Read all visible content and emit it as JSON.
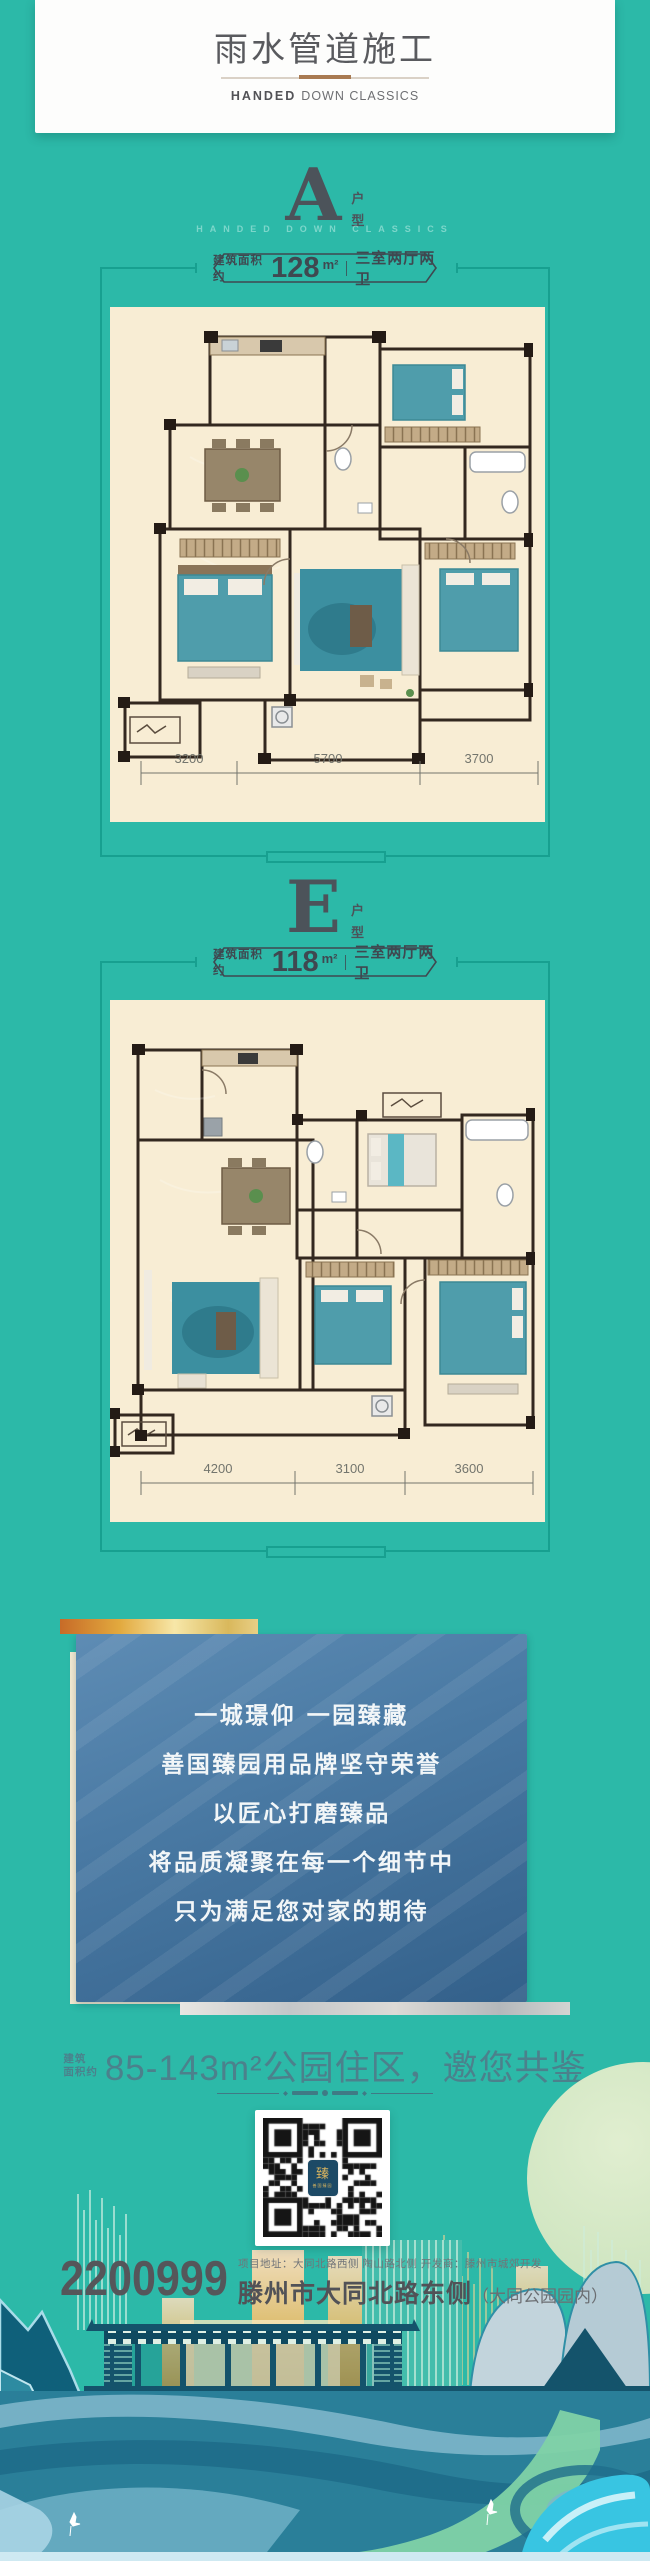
{
  "header": {
    "title": "雨水管道施工",
    "subtitle_bold": "HANDED",
    "subtitle_rest": "DOWN CLASSICS"
  },
  "sections": [
    {
      "letter": "A",
      "type_char_1": "户",
      "type_char_2": "型",
      "caption": "HANDED DOWN CLASSICS",
      "area_prefix": "建筑面积约",
      "area_value": "128",
      "area_unit": "m²",
      "spec": "三室两厅两卫",
      "dims": [
        "3200",
        "5700",
        "3700"
      ]
    },
    {
      "letter": "E",
      "type_char_1": "户",
      "type_char_2": "型",
      "caption": "",
      "area_prefix": "建筑面积约",
      "area_value": "118",
      "area_unit": "m²",
      "spec": "三室两厅两卫",
      "dims": [
        "4200",
        "3100",
        "3600"
      ]
    }
  ],
  "promo": {
    "lines": [
      "一城璟仰 一园臻藏",
      "善国臻园用品牌坚守荣誉",
      "以匠心打磨臻品",
      "将品质凝聚在每一个细节中",
      "只为满足您对家的期待"
    ]
  },
  "offer": {
    "small_1": "建筑",
    "small_2": "面积约",
    "text": "85-143m²公园住区，邀您共鉴"
  },
  "qr": {
    "logo_char": "臻",
    "logo_sub": "善国臻园"
  },
  "contact": {
    "phone": "2200999",
    "address_small": "项目地址：大同北路西侧 陶山路北侧 开发商：滕州市城郊开发",
    "address_main": "滕州市大同北路东侧",
    "address_note": "（大同公园园内）"
  },
  "colors": {
    "teal_bg": "#2cb9a8",
    "frame": "#17a090",
    "cream": "#f8edd4",
    "slate": "#4c535a",
    "blue_top": "#5e8cb4",
    "blue_bottom": "#33608a",
    "gold": "#e2b95c",
    "accent_text": "#4b818c"
  }
}
